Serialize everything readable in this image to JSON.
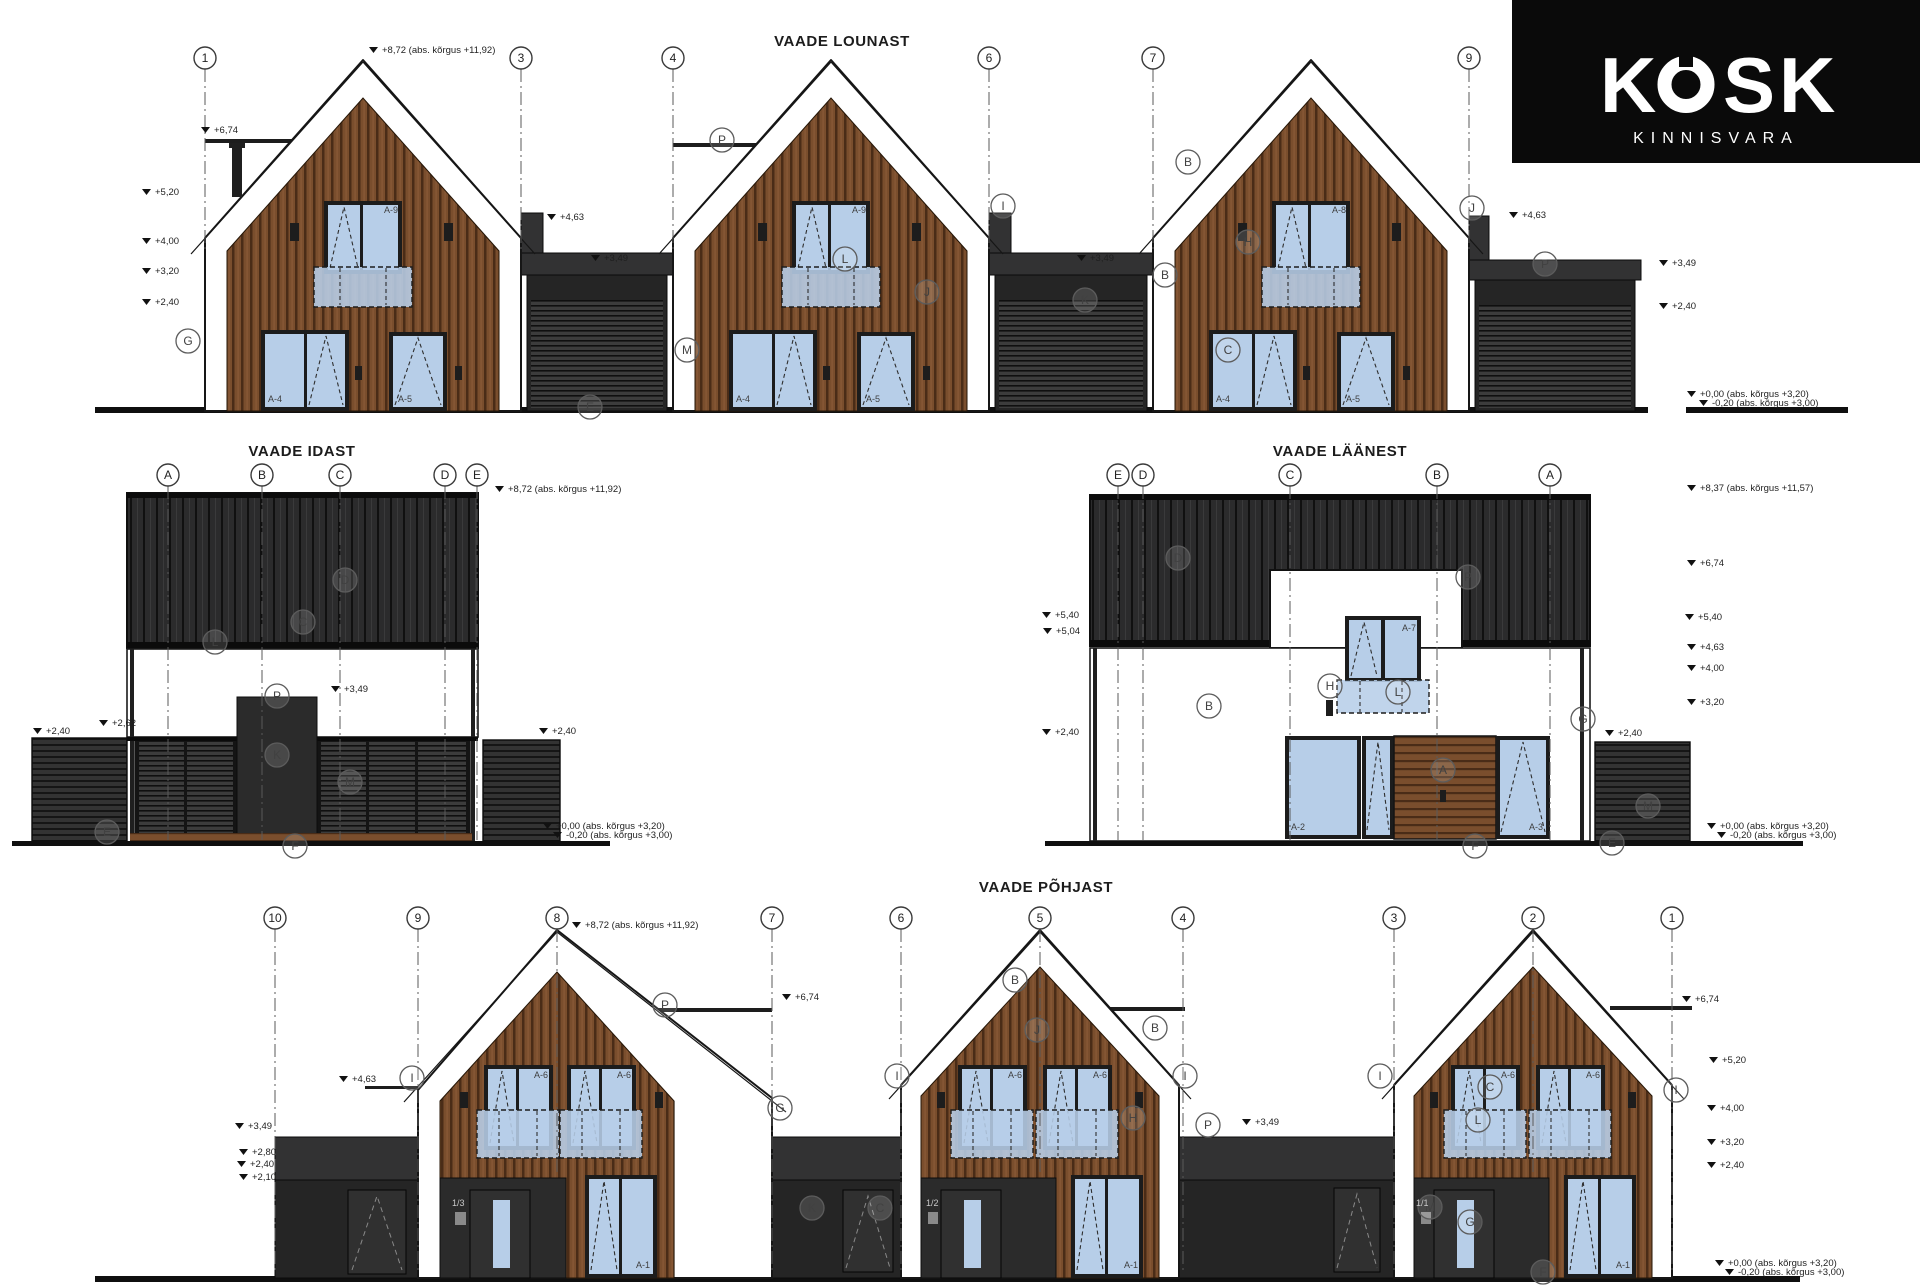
{
  "logo": {
    "brand": "KOSK",
    "sub": "KINNISVARA",
    "bg": "#0a0a0a",
    "fg": "#ffffff"
  },
  "colors": {
    "wood": "#7a4e2d",
    "wood_line": "#4a2c17",
    "cladding": "#2b2b2c",
    "cladding_seam": "#101010",
    "slat": "#333333",
    "slat_line": "#151515",
    "grill": "#3c3c3c",
    "grill_line": "#0f0f0f",
    "window": "#b7cee8",
    "frame": "#1c1c1c",
    "garage": "#252525",
    "ink": "#161616",
    "annotation": "#1f1f1f",
    "paper": "#ffffff"
  },
  "views": [
    {
      "id": "lounast",
      "title": "VAADE LOUNAST",
      "title_pos": [
        842,
        46
      ],
      "grid_y": 58,
      "grid_line_to": 252,
      "grids": [
        {
          "n": "1",
          "x": 205
        },
        {
          "n": "3",
          "x": 521
        },
        {
          "n": "4",
          "x": 673
        },
        {
          "n": "6",
          "x": 989
        },
        {
          "n": "7",
          "x": 1153
        },
        {
          "n": "9",
          "x": 1469
        }
      ],
      "levels": [
        {
          "t": "+8,72 (abs. kõrgus +11,92)",
          "x": 382,
          "y": 53
        },
        {
          "t": "+6,74",
          "x": 214,
          "y": 133
        },
        {
          "t": "+5,20",
          "x": 155,
          "y": 195
        },
        {
          "t": "+4,00",
          "x": 155,
          "y": 244
        },
        {
          "t": "+3,20",
          "x": 155,
          "y": 274
        },
        {
          "t": "+2,40",
          "x": 155,
          "y": 305
        },
        {
          "t": "+4,63",
          "x": 560,
          "y": 220
        },
        {
          "t": "+3,49",
          "x": 604,
          "y": 261
        },
        {
          "t": "+3,49",
          "x": 1090,
          "y": 261
        },
        {
          "t": "+4,63",
          "x": 1522,
          "y": 218
        },
        {
          "t": "+3,49",
          "x": 1672,
          "y": 266
        },
        {
          "t": "+2,40",
          "x": 1672,
          "y": 309
        },
        {
          "t": "+0,00 (abs. kõrgus +3,20)",
          "x": 1700,
          "y": 397
        },
        {
          "t": "-0,20 (abs. kõrgus +3,00)",
          "x": 1712,
          "y": 406
        }
      ],
      "letters": [
        {
          "t": "G",
          "x": 188,
          "y": 341
        },
        {
          "t": "P",
          "x": 722,
          "y": 140
        },
        {
          "t": "M",
          "x": 687,
          "y": 350
        },
        {
          "t": "E",
          "x": 590,
          "y": 407
        },
        {
          "t": "L",
          "x": 845,
          "y": 259
        },
        {
          "t": "J",
          "x": 927,
          "y": 292
        },
        {
          "t": "I",
          "x": 1003,
          "y": 206
        },
        {
          "t": "K",
          "x": 1085,
          "y": 300
        },
        {
          "t": "B",
          "x": 1188,
          "y": 162
        },
        {
          "t": "B",
          "x": 1165,
          "y": 275
        },
        {
          "t": "C",
          "x": 1228,
          "y": 350
        },
        {
          "t": "H",
          "x": 1248,
          "y": 242
        },
        {
          "t": "J",
          "x": 1472,
          "y": 208
        },
        {
          "t": "P",
          "x": 1545,
          "y": 264
        }
      ],
      "tags": [
        {
          "t": "A-9",
          "x": 398,
          "y": 213,
          "a": "end"
        },
        {
          "t": "A-4",
          "x": 268,
          "y": 402
        },
        {
          "t": "A-5",
          "x": 398,
          "y": 402
        },
        {
          "t": "A-9",
          "x": 866,
          "y": 213,
          "a": "end"
        },
        {
          "t": "A-4",
          "x": 736,
          "y": 402
        },
        {
          "t": "A-5",
          "x": 866,
          "y": 402
        },
        {
          "t": "A-8",
          "x": 1346,
          "y": 213,
          "a": "end"
        },
        {
          "t": "A-4",
          "x": 1216,
          "y": 402
        },
        {
          "t": "A-5",
          "x": 1346,
          "y": 402
        }
      ]
    },
    {
      "id": "idast",
      "title": "VAADE IDAST",
      "title_pos": [
        302,
        456
      ],
      "grid_y": 475,
      "grid_line_to": 840,
      "grids": [
        {
          "n": "A",
          "x": 168
        },
        {
          "n": "B",
          "x": 262
        },
        {
          "n": "C",
          "x": 340
        },
        {
          "n": "D",
          "x": 445
        },
        {
          "n": "E",
          "x": 477
        }
      ],
      "levels": [
        {
          "t": "+8,72 (abs. kõrgus +11,92)",
          "x": 508,
          "y": 492
        },
        {
          "t": "+3,49",
          "x": 344,
          "y": 692
        },
        {
          "t": "+2,62",
          "x": 112,
          "y": 726
        },
        {
          "t": "+2,40",
          "x": 46,
          "y": 734
        },
        {
          "t": "+2,40",
          "x": 552,
          "y": 734
        },
        {
          "t": "+0,00 (abs. kõrgus +3,20)",
          "x": 556,
          "y": 829
        },
        {
          "t": "-0,20 (abs. kõrgus +3,00)",
          "x": 566,
          "y": 838
        }
      ],
      "letters": [
        {
          "t": "D",
          "x": 345,
          "y": 580
        },
        {
          "t": "C",
          "x": 303,
          "y": 622
        },
        {
          "t": "L",
          "x": 215,
          "y": 642
        },
        {
          "t": "P",
          "x": 277,
          "y": 696
        },
        {
          "t": "K",
          "x": 277,
          "y": 755
        },
        {
          "t": "M",
          "x": 350,
          "y": 782
        },
        {
          "t": "E",
          "x": 107,
          "y": 832
        },
        {
          "t": "F",
          "x": 295,
          "y": 846
        }
      ],
      "tags": []
    },
    {
      "id": "laanest",
      "title": "VAADE LÄÄNEST",
      "title_pos": [
        1340,
        456
      ],
      "grid_y": 475,
      "grid_line_to": 840,
      "grids": [
        {
          "n": "E",
          "x": 1118
        },
        {
          "n": "D",
          "x": 1143
        },
        {
          "n": "C",
          "x": 1290
        },
        {
          "n": "B",
          "x": 1437
        },
        {
          "n": "A",
          "x": 1550
        }
      ],
      "levels": [
        {
          "t": "+8,37 (abs. kõrgus +11,57)",
          "x": 1700,
          "y": 491
        },
        {
          "t": "+6,74",
          "x": 1700,
          "y": 566
        },
        {
          "t": "+5,40",
          "x": 1698,
          "y": 620
        },
        {
          "t": "+4,63",
          "x": 1700,
          "y": 650
        },
        {
          "t": "+4,00",
          "x": 1700,
          "y": 671
        },
        {
          "t": "+3,20",
          "x": 1700,
          "y": 705
        },
        {
          "t": "+2,40",
          "x": 1618,
          "y": 736
        },
        {
          "t": "+0,00 (abs. kõrgus +3,20)",
          "x": 1720,
          "y": 829
        },
        {
          "t": "-0,20 (abs. kõrgus +3,00)",
          "x": 1730,
          "y": 838
        },
        {
          "t": "+5,40",
          "x": 1055,
          "y": 618
        },
        {
          "t": "+5,04",
          "x": 1056,
          "y": 634
        },
        {
          "t": "+2,40",
          "x": 1055,
          "y": 735
        }
      ],
      "letters": [
        {
          "t": "D",
          "x": 1178,
          "y": 558
        },
        {
          "t": "P",
          "x": 1468,
          "y": 577
        },
        {
          "t": "B",
          "x": 1209,
          "y": 706
        },
        {
          "t": "H",
          "x": 1330,
          "y": 686
        },
        {
          "t": "L",
          "x": 1398,
          "y": 692
        },
        {
          "t": "A",
          "x": 1443,
          "y": 770
        },
        {
          "t": "G",
          "x": 1583,
          "y": 719
        },
        {
          "t": "M",
          "x": 1648,
          "y": 806
        },
        {
          "t": "F",
          "x": 1475,
          "y": 846
        },
        {
          "t": "E",
          "x": 1612,
          "y": 843
        }
      ],
      "tags": [
        {
          "t": "A-7",
          "x": 1416,
          "y": 631,
          "a": "end"
        },
        {
          "t": "A-2",
          "x": 1291,
          "y": 830
        },
        {
          "t": "A-3",
          "x": 1543,
          "y": 830,
          "a": "end"
        }
      ]
    },
    {
      "id": "pohjast",
      "title": "VAADE PÕHJAST",
      "title_pos": [
        1046,
        892
      ],
      "grid_y": 918,
      "grid_line_to": 1274,
      "grids": [
        {
          "n": "10",
          "x": 275
        },
        {
          "n": "9",
          "x": 418
        },
        {
          "n": "8",
          "x": 557,
          "to": 1172
        },
        {
          "n": "7",
          "x": 772
        },
        {
          "n": "6",
          "x": 901
        },
        {
          "n": "5",
          "x": 1040,
          "to": 1172
        },
        {
          "n": "4",
          "x": 1183
        },
        {
          "n": "3",
          "x": 1394
        },
        {
          "n": "2",
          "x": 1533,
          "to": 1172
        },
        {
          "n": "1",
          "x": 1672
        }
      ],
      "levels": [
        {
          "t": "+8,72 (abs. kõrgus +11,92)",
          "x": 585,
          "y": 928
        },
        {
          "t": "+6,74",
          "x": 795,
          "y": 1000
        },
        {
          "t": "+4,63",
          "x": 352,
          "y": 1082
        },
        {
          "t": "+3,49",
          "x": 248,
          "y": 1129
        },
        {
          "t": "+2,80",
          "x": 252,
          "y": 1155
        },
        {
          "t": "+2,40",
          "x": 250,
          "y": 1167
        },
        {
          "t": "+2,10",
          "x": 252,
          "y": 1180
        },
        {
          "t": "+3,49",
          "x": 1255,
          "y": 1125
        },
        {
          "t": "+6,74",
          "x": 1695,
          "y": 1002
        },
        {
          "t": "+5,20",
          "x": 1722,
          "y": 1063
        },
        {
          "t": "+4,00",
          "x": 1720,
          "y": 1111
        },
        {
          "t": "+3,20",
          "x": 1720,
          "y": 1145
        },
        {
          "t": "+2,40",
          "x": 1720,
          "y": 1168
        },
        {
          "t": "+0,00 (abs. kõrgus +3,20)",
          "x": 1728,
          "y": 1266
        },
        {
          "t": "-0,20 (abs. kõrgus +3,00)",
          "x": 1738,
          "y": 1275
        }
      ],
      "letters": [
        {
          "t": "P",
          "x": 665,
          "y": 1005
        },
        {
          "t": "I",
          "x": 412,
          "y": 1078
        },
        {
          "t": "G",
          "x": 780,
          "y": 1108
        },
        {
          "t": "I",
          "x": 897,
          "y": 1076
        },
        {
          "t": "B",
          "x": 1015,
          "y": 980
        },
        {
          "t": "J",
          "x": 1037,
          "y": 1030
        },
        {
          "t": "B",
          "x": 1155,
          "y": 1028
        },
        {
          "t": "H",
          "x": 1133,
          "y": 1118
        },
        {
          "t": "I",
          "x": 1185,
          "y": 1076
        },
        {
          "t": "K",
          "x": 812,
          "y": 1208
        },
        {
          "t": "C",
          "x": 880,
          "y": 1208
        },
        {
          "t": "P",
          "x": 1208,
          "y": 1125
        },
        {
          "t": "I",
          "x": 1380,
          "y": 1076
        },
        {
          "t": "C",
          "x": 1490,
          "y": 1087
        },
        {
          "t": "L",
          "x": 1478,
          "y": 1120
        },
        {
          "t": "M",
          "x": 1430,
          "y": 1207
        },
        {
          "t": "G",
          "x": 1470,
          "y": 1222
        },
        {
          "t": "F",
          "x": 1543,
          "y": 1272
        },
        {
          "t": "I",
          "x": 1676,
          "y": 1090
        }
      ],
      "tags": [
        {
          "t": "A-6",
          "x": 548,
          "y": 1078,
          "a": "end"
        },
        {
          "t": "A-6",
          "x": 631,
          "y": 1078,
          "a": "end"
        },
        {
          "t": "A-1",
          "x": 650,
          "y": 1268,
          "a": "end"
        },
        {
          "t": "1/3",
          "x": 452,
          "y": 1206,
          "light": true
        },
        {
          "t": "A-6",
          "x": 1022,
          "y": 1078,
          "a": "end"
        },
        {
          "t": "A-6",
          "x": 1107,
          "y": 1078,
          "a": "end"
        },
        {
          "t": "A-1",
          "x": 1138,
          "y": 1268,
          "a": "end"
        },
        {
          "t": "1/2",
          "x": 926,
          "y": 1206,
          "light": true
        },
        {
          "t": "A-6",
          "x": 1515,
          "y": 1078,
          "a": "end"
        },
        {
          "t": "A-6",
          "x": 1600,
          "y": 1078,
          "a": "end"
        },
        {
          "t": "A-1",
          "x": 1630,
          "y": 1268,
          "a": "end"
        },
        {
          "t": "1/1",
          "x": 1416,
          "y": 1206,
          "light": true
        }
      ]
    }
  ]
}
